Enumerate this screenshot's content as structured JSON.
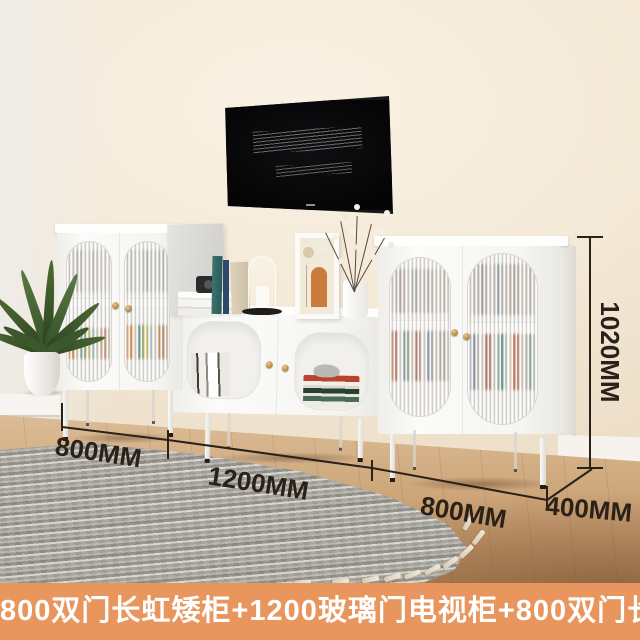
{
  "caption_banner": {
    "text": "800双门长虹矮柜+1200玻璃门电视柜+800双门长虹矮柜"
  },
  "dimension_labels": {
    "left_cabinet_width": "800MM",
    "tv_cabinet_width": "1200MM",
    "right_cabinet_width": "800MM",
    "cabinet_depth": "400MM",
    "cabinet_height": "1020MM"
  },
  "colors": {
    "banner_background": "#E8965E",
    "banner_text": "#FFFFFF",
    "dimension_annotation": "#2A2118",
    "wall_cream": "#F3E8D6",
    "floor_wood": "#C49A6E",
    "rug_gray": "#A6A49D",
    "cabinet_white": "#F7F6F3",
    "handle_gold": "#C9A254",
    "tv_screen_black": "#0A0A0B",
    "plant_green": "#3F5C33"
  }
}
